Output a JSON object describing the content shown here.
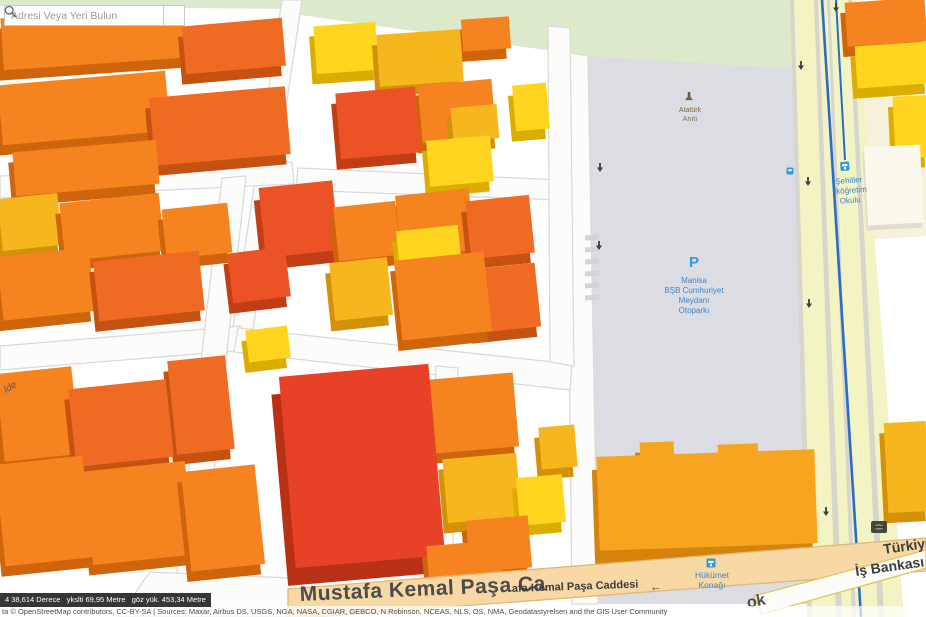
{
  "search": {
    "placeholder": "Adresi Veya Yeri Bulun",
    "icon": "search-icon"
  },
  "status_bar": {
    "text": "4 38,614 Derece   ykslti 69,95 Metre   göz yük. 453,34 Metre"
  },
  "attribution": {
    "text": "ta © OpenStreetMap contributors, CC-BY-SA | Sources: Maxar, Airbus DS, USGS, NGA, NASA, CGIAR, GEBCO, N.Robinson, NCEAS, NLS, OS, NMA, Geodatastyrelsen and the GIS User Community"
  },
  "palette": {
    "park": "#dde9cb",
    "cream_area": "#f6f1db",
    "plaza": "#dcdce3",
    "road_yellow": "#f3f3c3",
    "curb": "#d6d6ce",
    "road_white": "#fcfcfa",
    "road_edge": "#dadad8",
    "road_orange": "#f8d8a4",
    "road_orange_edge": "#e0b878",
    "road_yellow_edge": "#e4c652",
    "tram": "#2b6cc5",
    "arrow": "#3f3f3f",
    "poi_blue": "#3f86c6",
    "poi_icon_blue": "#2f9bd8",
    "poi_brown": "#7c6a50",
    "label_dark": "#4c4c4c",
    "buildings": {
      "orange": {
        "top": "#F5831F",
        "side": "#CE650D"
      },
      "deepOrange": {
        "top": "#EF6A22",
        "side": "#C55211"
      },
      "redOrange": {
        "top": "#EB5226",
        "side": "#C13D15"
      },
      "red": {
        "top": "#E74127",
        "side": "#B93115"
      },
      "yellow": {
        "top": "#FFD51F",
        "side": "#DAAD00"
      },
      "amber": {
        "top": "#F6B71E",
        "side": "#D29109"
      },
      "lightOrange": {
        "top": "#F7A420",
        "side": "#D4830C"
      },
      "cream": {
        "top": "#fbf8ee",
        "side": "#e0ddcd"
      }
    }
  },
  "map": {
    "areas": [
      {
        "id": "park-strip-top-left",
        "points": "0,0 290,0 290,9 0,6",
        "color": "park"
      },
      {
        "id": "park-area",
        "points": "280,0 812,0 806,102 560,52 280,12",
        "color": "park"
      },
      {
        "id": "school-grounds",
        "points": "850,92 926,86 926,236 866,240",
        "color": "cream_area"
      },
      {
        "id": "plaza-cumhuriyet-meydani",
        "points": "586,56 812,70 824,604 592,604",
        "color": "plaza"
      },
      {
        "id": "road-right-boulevard",
        "points": "790,0 856,0 904,617 808,617",
        "color": "road_yellow"
      },
      {
        "id": "curb-line",
        "points": "790,0 794,0 812,617 807,617",
        "color": "curb"
      },
      {
        "id": "curb-line",
        "points": "814,0 818,0 842,617 836,617",
        "color": "curb"
      },
      {
        "id": "curb-line",
        "points": "827,0 830,0 856,617 852,617",
        "color": "curb"
      },
      {
        "id": "curb-line",
        "points": "848,0 852,0 884,617 878,617",
        "color": "curb"
      },
      {
        "id": "road-plaza-west",
        "points": "566,52 588,56 598,604 572,604",
        "color": "road_white",
        "stroke": "road_edge"
      },
      {
        "id": "road-center-vertical",
        "points": "282,0 302,0 252,336 232,334",
        "color": "road_white",
        "stroke": "road_edge"
      },
      {
        "id": "road-left-horizontal-1",
        "points": "0,176 292,162 294,184 0,198",
        "color": "road_white",
        "stroke": "road_edge"
      },
      {
        "id": "road-left-horizontal-2",
        "points": "0,346 242,326 246,350 0,370",
        "color": "road_white",
        "stroke": "road_edge"
      },
      {
        "id": "road-left-vertical",
        "points": "222,178 246,176 202,582 176,580",
        "color": "road_white",
        "stroke": "road_edge"
      },
      {
        "id": "road-center-horizontal-2",
        "points": "238,328 572,364 570,390 234,352",
        "color": "road_white",
        "stroke": "road_edge"
      },
      {
        "id": "road-center-horizontal-1",
        "points": "298,168 562,180 560,200 296,190",
        "color": "road_white",
        "stroke": "road_edge"
      },
      {
        "id": "road-center-east-vertical",
        "points": "548,26 570,28 574,366 550,362",
        "color": "road_white",
        "stroke": "road_edge"
      },
      {
        "id": "road-red-block-east",
        "points": "436,366 458,368 452,582 428,580",
        "color": "road_white",
        "stroke": "road_edge"
      },
      {
        "id": "road-bottom-left-junction",
        "points": "150,572 290,578 290,617 118,617",
        "color": "road_white",
        "stroke": "road_edge"
      }
    ],
    "foreground_areas": [
      {
        "id": "road-mustafa-kemal-pasa",
        "points": "288,589 926,538 926,571 288,619",
        "color": "road_orange",
        "stroke": "road_orange_edge"
      },
      {
        "id": "road-ok-street",
        "points": "754,596 926,550 926,568 762,614",
        "color": "road_white",
        "stroke": "road_yellow_edge"
      }
    ],
    "tram_lines": [
      {
        "d": "M822,0 L861,617",
        "w": 2.6
      },
      {
        "d": "M836,0 L845,160",
        "w": 2
      }
    ],
    "crosswalk": {
      "x1": 585,
      "x2": 599,
      "y_start": 238,
      "y_end": 298,
      "step": 12
    },
    "arrows": [
      [
        600,
        168
      ],
      [
        599,
        246
      ],
      [
        801,
        66
      ],
      [
        808,
        182
      ],
      [
        809,
        304
      ],
      [
        826,
        512
      ],
      [
        836,
        8
      ]
    ],
    "buildings": [
      [
        2,
        12,
        182,
        52,
        -4,
        "orange"
      ],
      [
        184,
        22,
        100,
        48,
        -5,
        "deepOrange"
      ],
      [
        0,
        78,
        168,
        60,
        -5,
        "orange"
      ],
      [
        152,
        92,
        136,
        68,
        -5,
        "deepOrange"
      ],
      [
        14,
        146,
        144,
        44,
        -5,
        "orange"
      ],
      [
        0,
        196,
        60,
        52,
        -6,
        "amber"
      ],
      [
        62,
        198,
        100,
        58,
        -6,
        "orange"
      ],
      [
        164,
        206,
        66,
        50,
        -6,
        "orange"
      ],
      [
        0,
        252,
        92,
        64,
        -6,
        "orange"
      ],
      [
        96,
        256,
        106,
        60,
        -6,
        "deepOrange"
      ],
      [
        230,
        250,
        58,
        50,
        -7,
        "redOrange"
      ],
      [
        247,
        328,
        42,
        32,
        -7,
        "yellow"
      ],
      [
        0,
        370,
        76,
        88,
        -6,
        "orange"
      ],
      [
        72,
        384,
        98,
        78,
        -6,
        "deepOrange"
      ],
      [
        0,
        460,
        88,
        102,
        -6,
        "orange"
      ],
      [
        88,
        466,
        102,
        94,
        -6,
        "orange"
      ],
      [
        172,
        358,
        58,
        94,
        -6,
        "deepOrange"
      ],
      [
        186,
        468,
        74,
        100,
        -6,
        "orange"
      ],
      [
        315,
        24,
        62,
        48,
        -4,
        "yellow"
      ],
      [
        462,
        18,
        48,
        32,
        -4,
        "orange"
      ],
      [
        378,
        32,
        84,
        52,
        -4,
        "amber"
      ],
      [
        338,
        90,
        80,
        66,
        -5,
        "redOrange"
      ],
      [
        420,
        82,
        74,
        58,
        -5,
        "orange"
      ],
      [
        452,
        106,
        46,
        34,
        -5,
        "amber"
      ],
      [
        514,
        84,
        34,
        46,
        -5,
        "yellow"
      ],
      [
        428,
        138,
        64,
        46,
        -5,
        "yellow"
      ],
      [
        262,
        184,
        74,
        70,
        -6,
        "redOrange",
        [
          -6,
          12
        ]
      ],
      [
        336,
        204,
        62,
        54,
        -6,
        "orange"
      ],
      [
        398,
        192,
        74,
        62,
        -6,
        "orange"
      ],
      [
        468,
        198,
        64,
        58,
        -6,
        "deepOrange"
      ],
      [
        398,
        228,
        62,
        42,
        -6,
        "yellow"
      ],
      [
        332,
        260,
        58,
        58,
        -6,
        "amber"
      ],
      [
        398,
        256,
        90,
        80,
        -6,
        "orange"
      ],
      [
        472,
        266,
        66,
        64,
        -6,
        "deepOrange"
      ],
      [
        287,
        370,
        150,
        192,
        -5,
        "red",
        [
          -9,
          17
        ]
      ],
      [
        432,
        376,
        84,
        74,
        -5,
        "orange"
      ],
      [
        445,
        456,
        74,
        64,
        -5,
        "amber"
      ],
      [
        518,
        476,
        46,
        48,
        -5,
        "yellow"
      ],
      [
        468,
        518,
        62,
        52,
        -5,
        "orange"
      ],
      [
        428,
        543,
        74,
        42,
        -5,
        "orange"
      ],
      [
        540,
        426,
        36,
        42,
        -5,
        "amber"
      ],
      [
        640,
        442,
        34,
        22,
        -2,
        "lightOrange"
      ],
      [
        718,
        444,
        40,
        22,
        -2,
        "lightOrange"
      ],
      [
        598,
        453,
        218,
        94,
        -2,
        "lightOrange",
        [
          -5,
          13
        ]
      ],
      [
        846,
        0,
        80,
        44,
        -4,
        "orange"
      ],
      [
        856,
        44,
        72,
        42,
        -4,
        "yellow"
      ],
      [
        866,
        146,
        56,
        78,
        -3,
        "cream",
        [
          -2,
          5
        ]
      ],
      [
        894,
        96,
        34,
        62,
        -3,
        "yellow"
      ],
      [
        886,
        422,
        42,
        90,
        -3,
        "amber"
      ]
    ],
    "pois": [
      {
        "id": "ataturk-aniti",
        "icon": "monument-icon",
        "ix": 689,
        "iy": 100,
        "lines": [
          "Atatürk",
          "Anıtı"
        ],
        "x": 690,
        "y": 112,
        "lh": 9,
        "size": 7,
        "color": "#7c6a50"
      },
      {
        "id": "otopark",
        "icon": "parking-icon",
        "ix": 694,
        "iy": 262,
        "lines": [
          "Manisa",
          "BŞB Cumhuriyet",
          "Meydanı",
          "Otoparkı"
        ],
        "x": 694,
        "y": 283,
        "lh": 10,
        "size": 8,
        "color": "#3f86c6"
      },
      {
        "id": "sehitler-ilkogretim-okulu",
        "icon": "school-icon",
        "ix": 846,
        "iy": 166,
        "lines": [
          "Şehitler",
          "İlköğretim",
          "Okulu"
        ],
        "x": 849,
        "y": 183,
        "lh": 10,
        "size": 8,
        "color": "#3f86c6",
        "rot": -4
      },
      {
        "id": "hukumet-konagi",
        "icon": "government-icon",
        "ix": 711,
        "iy": 563,
        "lines": [
          "Hükümet",
          "Konağı"
        ],
        "x": 712,
        "y": 578,
        "lh": 10,
        "size": 8.5,
        "color": "#3f86c6"
      },
      {
        "id": "bus-stop",
        "icon": "bus-stop-icon",
        "ix": 790,
        "iy": 171,
        "lines": [],
        "x": 790,
        "y": 171,
        "lh": 0,
        "size": 8,
        "color": "#3f86c6"
      },
      {
        "id": "is-bankasi-atm",
        "icon": "bank-icon",
        "ix": 879,
        "iy": 527,
        "lines": [],
        "x": 879,
        "y": 527,
        "lh": 0,
        "size": 8,
        "color": "#3f3f3f"
      }
    ],
    "street_labels": [
      {
        "id": "street-label-mustafa-kemal-pasa-main",
        "text": "Mustafa Kemal Paşa Ca",
        "x": 300,
        "y": 601,
        "size": 21,
        "weight": "bold",
        "color": "#4c4c4c",
        "rot": -2.5,
        "spacing": 0.5
      },
      {
        "id": "street-label-mustafa-kemal-pasa-caddesi",
        "text": "afa Kemal Paşa Caddesi",
        "x": 512,
        "y": 592,
        "size": 11,
        "weight": "bold",
        "color": "#3c3c3c",
        "rot": -2
      },
      {
        "id": "street-direction-arrow",
        "text": "←",
        "x": 650,
        "y": 591,
        "size": 12,
        "weight": "normal",
        "color": "#3c3c3c",
        "rot": -2
      },
      {
        "id": "street-label-ok",
        "text": "ok",
        "x": 748,
        "y": 608,
        "size": 16,
        "weight": "bold",
        "color": "#4c4c4c",
        "rot": -12
      },
      {
        "id": "street-label-lde",
        "text": "lde",
        "x": 6,
        "y": 393,
        "size": 10,
        "weight": "normal",
        "style": "italic",
        "color": "#5a5a5a",
        "rot": -30
      },
      {
        "id": "bank-label-line1",
        "text": "Türkiye",
        "x": 884,
        "y": 554,
        "size": 14,
        "weight": "bold",
        "color": "#3c3c3c",
        "rot": -8
      },
      {
        "id": "bank-label-line2",
        "text": "İş Bankası",
        "x": 856,
        "y": 576,
        "size": 14,
        "weight": "bold",
        "color": "#3c3c3c",
        "rot": -8
      }
    ]
  }
}
